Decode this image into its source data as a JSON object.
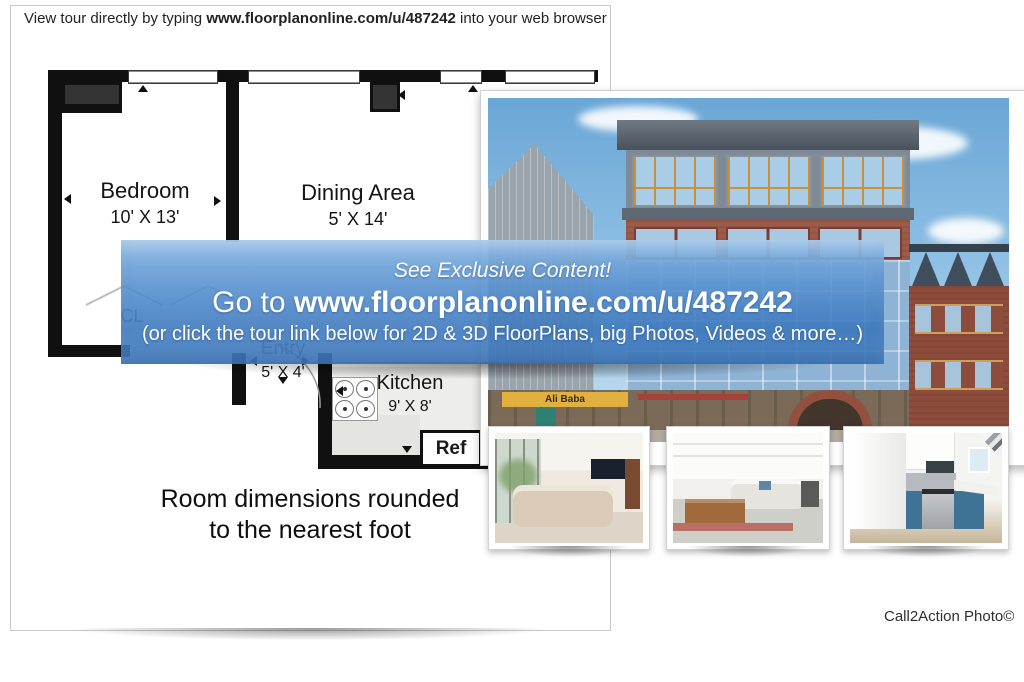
{
  "header": {
    "prefix": "View tour directly by typing ",
    "url": "www.floorplanonline.com/u/487242",
    "suffix": " into your web browser"
  },
  "floorplan": {
    "rooms": [
      {
        "name": "Bedroom",
        "dims": "10' X 13'"
      },
      {
        "name": "Dining Area",
        "dims": "5' X 14'"
      },
      {
        "name": "Entry",
        "dims": "5' X 4'"
      },
      {
        "name": "Kitchen",
        "dims": "9' X 8'"
      }
    ],
    "closet_label": "CL",
    "fridge_label": "Ref",
    "footnote": [
      "Room dimensions rounded",
      "to the nearest foot"
    ]
  },
  "banner": {
    "tagline": "See Exclusive Content!",
    "cta_prefix": "Go to ",
    "cta_url": "www.floorplanonline.com/u/487242",
    "subtext": "(or click the tour link below for 2D & 3D FloorPlans, big Photos, Videos & more…)",
    "colors": {
      "blue_top": "#85b4e2",
      "blue_bottom": "#3a76bc",
      "text": "#ffffff"
    }
  },
  "photo": {
    "sign_text": "Ali Baba"
  },
  "credit": "Call2Action Photo©"
}
